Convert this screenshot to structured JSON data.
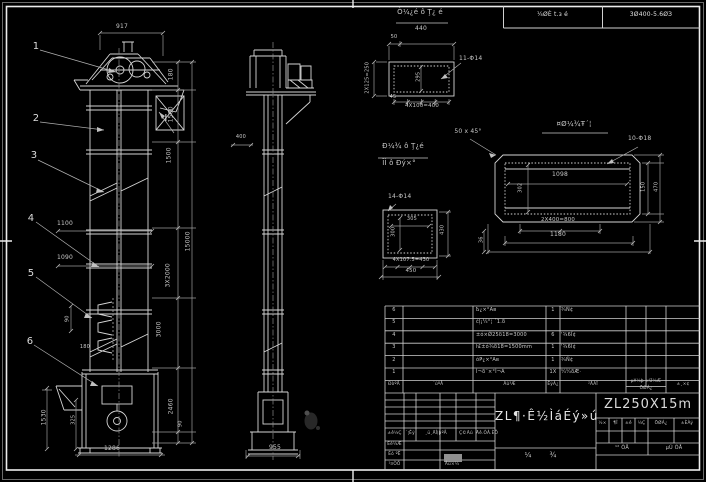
{
  "top_bar": {
    "motor_cell": "¼ØÈ t.з é",
    "reducer_cell": "3Ø400-5.6ØЗ"
  },
  "front_view": {
    "dim_top": "917",
    "balloon_1": "1",
    "balloon_2": "2",
    "balloon_3": "3",
    "balloon_4": "4",
    "balloon_5": "5",
    "balloon_6": "6",
    "detail_marker": "Ⅰ",
    "dim_180": "180",
    "dim_1500a": "1500",
    "dim_1500b": "1500",
    "dim_3x2000": "3X2000",
    "dim_3000": "3000",
    "dim_2460": "2460",
    "dim_90r": "90",
    "dim_total": "15000",
    "dim_1100": "1100",
    "dim_1090": "1090",
    "dim_90l": "90",
    "dim_180b": "180",
    "dim_1530": "1530",
    "dim_325": "325",
    "dim_bottom": "1286"
  },
  "side_view": {
    "dim_400": "400",
    "dim_bottom": "955"
  },
  "detail_a": {
    "title": "Ò¼¿é ô Ţ¿ é",
    "dim_top": "440",
    "dim_50": "50",
    "dim_left": "2X125=250",
    "dim_inner": "295",
    "dim_45": "45",
    "dim_bottom": "4X100=400",
    "holes": "11-Φ14"
  },
  "detail_b": {
    "title": "¤Ø¼¾Ŧ´¦",
    "chamfer": "50 x 45°",
    "holes": "10-Φ18",
    "dim_1098": "1098",
    "dim_302": "302",
    "dim_150": "150",
    "dim_470": "470",
    "dim_2x400": "2X400=800",
    "dim_1180": "1180",
    "dim_36": "36"
  },
  "detail_c": {
    "title_1": "Ð¼¾ ô Ţ¿é",
    "title_2": "Ĭİ ô Ðý×°",
    "holes": "14-Φ14",
    "dim_305": "305",
    "dim_300": "300",
    "dim_430": "430",
    "dim_bottom": "4X107.5=430",
    "dim_450": "450"
  },
  "bom": {
    "headers": {
      "no": "ÐòºÅ",
      "code": "´úºÅ",
      "name": "Ãû³Æ",
      "qty": "ÊýÁ¿",
      "material": "²ÄÁÏ",
      "weight_1": "µ¥¼þ ×Ü¼Æ",
      "weight_2": "ÖØÁ¿",
      "note": "±¸×¢"
    },
    "rows": [
      {
        "no": "6",
        "name": "Ҍ¿×°Ав",
        "qty": "1",
        "material": "¾Ñ¢"
      },
      {
        "no": "5",
        "name": "ċļ¡¼°¦ ´1.δ",
        "qty": "",
        "material": ""
      },
      {
        "no": "4",
        "name": "±ó×Ǿ25δ18=3000",
        "qty": "6",
        "material": "'¾6Ï¢"
      },
      {
        "no": "3",
        "name": "ŀ£±ó¾δ18=1500mm",
        "qty": "1",
        "material": "'¾6Ï¢"
      },
      {
        "no": "2",
        "name": "óҎ¿×°Ав",
        "qty": "1",
        "material": "¾Ñ¢"
      },
      {
        "no": "1",
        "name": "Ì¬δ¨×°Ì¬Ã",
        "qty": "1X",
        "material": "¼¼δÆ·"
      }
    ]
  },
  "title_block": {
    "drawing_title": "ZL¶·Ê½ÌáÉý»ú",
    "model": "ZL250X15m",
    "stage_1": "½×",
    "stage_2": "¶Î",
    "stage_3": "±ê",
    "stage_4": "¼Ç",
    "weight_label": "ÖØÁ¿",
    "scale_label": "±ÈÀý",
    "sheets_total": "¹² ÕÅ",
    "sheet_no": "µÚ ÕÅ",
    "rev_mark": "±ê¼Ç",
    "rev_count": "´¦Êý",
    "rev_doc": "¸ü¸ÄÎļþºÅ",
    "rev_sign": "Ç©Ãû",
    "rev_date": "Äê.ÔÂ.ÈÕ",
    "design_label": "Éè¼Æ",
    "check_label": "Éó ºË",
    "process_label": "¹¤ÒÕ",
    "approve_label": "Åú×¼",
    "stamp_1": "¼",
    "stamp_2": "¾"
  }
}
